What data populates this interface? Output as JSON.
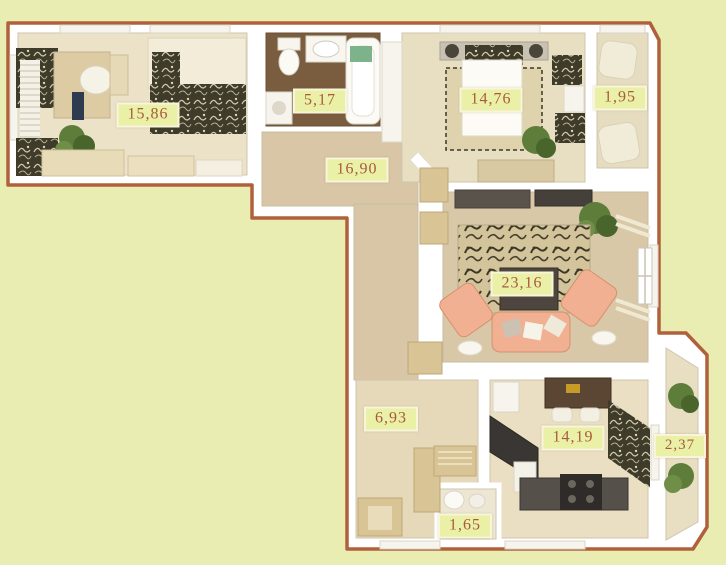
{
  "plan": {
    "title": "apartment-floor-plan",
    "colors": {
      "background": "#e9edb2",
      "outline": "#b0613c",
      "wall": "#ffffff",
      "label_bg": "#eaf0a6",
      "label_border": "#f8f5dc",
      "label_text": "#a85a40",
      "floor_light": "#e8dec2",
      "floor_corridor": "#d8c6a6",
      "bathroom_floor": "#7a5c3e",
      "accent_peach": "#f0b091",
      "plant_green": "#5f7d3a",
      "dark_counter": "#3a3633"
    }
  },
  "rooms": [
    {
      "name": "cabinet",
      "area": "15,86"
    },
    {
      "name": "bathroom",
      "area": "5,17"
    },
    {
      "name": "hallway",
      "area": "16,90"
    },
    {
      "name": "bedroom",
      "area": "14,76"
    },
    {
      "name": "balcony-top",
      "area": "1,95"
    },
    {
      "name": "living-room",
      "area": "23,16"
    },
    {
      "name": "corridor",
      "area": "6,93"
    },
    {
      "name": "kitchen",
      "area": "14,19"
    },
    {
      "name": "balcony-bottom",
      "area": "2,37"
    },
    {
      "name": "wc",
      "area": "1,65"
    }
  ]
}
